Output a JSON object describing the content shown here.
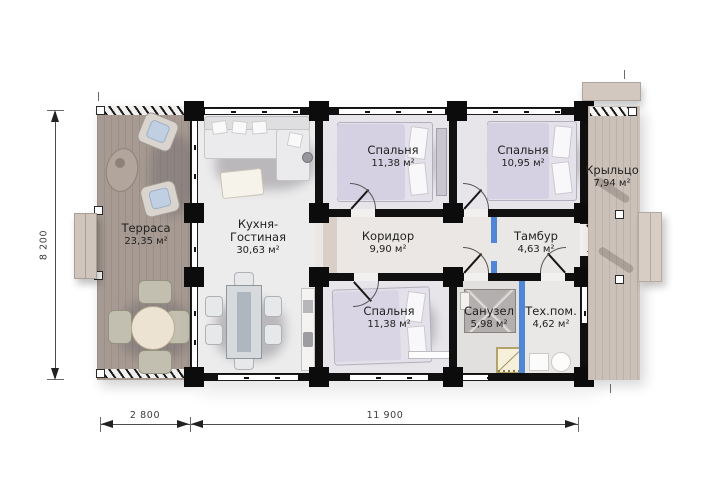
{
  "rooms": [
    {
      "name": "Терраса",
      "area": "23,35 м²"
    },
    {
      "name": "Кухня-",
      "name2": "Гостиная",
      "area": "30,63 м²"
    },
    {
      "name": "Спальня",
      "area": "11,38 м²"
    },
    {
      "name": "Спальня",
      "area": "10,95 м²"
    },
    {
      "name": "Крыльцо",
      "area": "7,94 м²"
    },
    {
      "name": "Коридор",
      "area": "9,90 м²"
    },
    {
      "name": "Тамбур",
      "area": "4,63 м²"
    },
    {
      "name": "Спальня",
      "area": "11,38 м²"
    },
    {
      "name": "Санузел",
      "area": "5,98 м²"
    },
    {
      "name": "Тех.пом.",
      "area": "4,62 м²"
    }
  ],
  "dimensions": {
    "side_height": "8 200",
    "terrace_width": "2 800",
    "house_width": "11 900"
  },
  "colors": {
    "wall": "#101010",
    "accent_blue": "#4f86d8",
    "terrace_deck": "#a69a92",
    "porch_deck": "#ccc1b9",
    "shower_trim": "#b3a269"
  }
}
